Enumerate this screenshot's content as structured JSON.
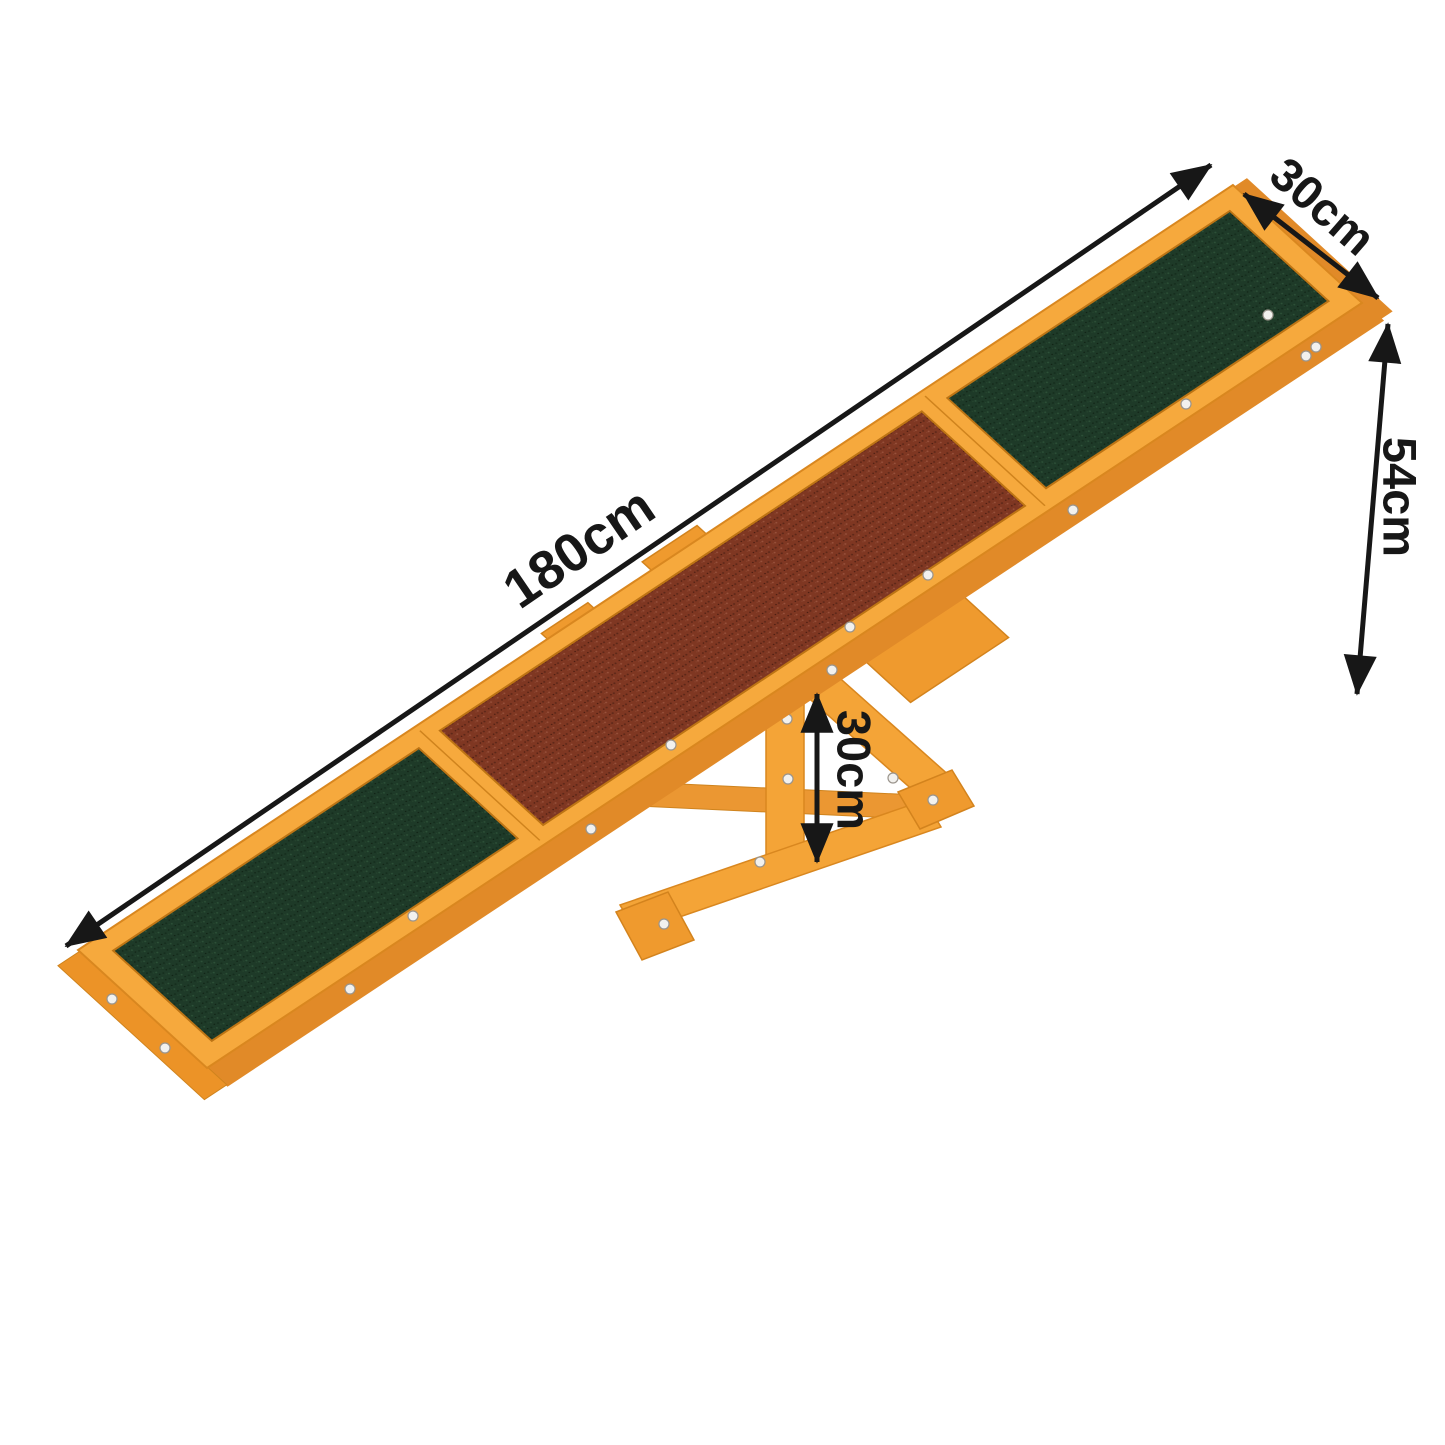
{
  "image": {
    "description": "Wooden pet agility seesaw with anti-slip pads, shown on white background with dimension arrows",
    "background_color": "#ffffff"
  },
  "dimensions": {
    "length": "180cm",
    "width": "30cm",
    "end_height": "54cm",
    "pivot_height": "30cm"
  },
  "colors": {
    "wood_top": "#f6a93d",
    "wood_side": "#e18a28",
    "wood_outline": "#d9871f",
    "pad_green": "#1e3a28",
    "pad_brown": "#7f3722",
    "annotation": "#171717",
    "screw": "#f2f1ee"
  }
}
